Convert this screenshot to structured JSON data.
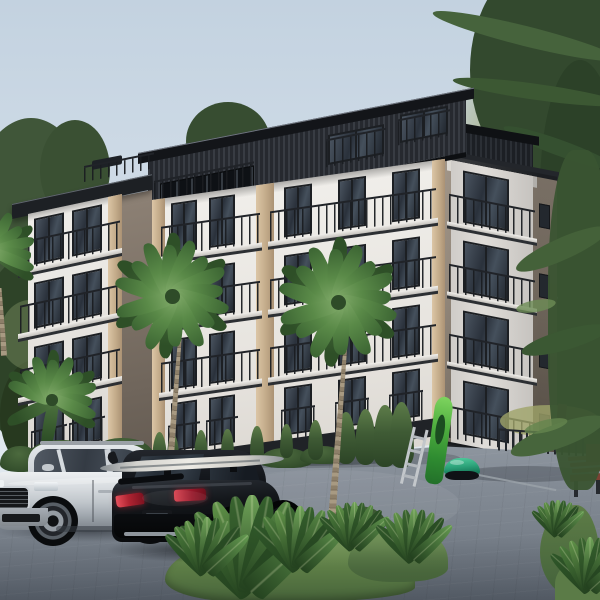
{
  "scene": {
    "type": "photorealistic architectural rendering",
    "subject": "Modern four-storey apartment building with dark ribbed rooftop penthouse, white and beige facades, black metal balcony railings, palm trees, parked cars and a landscaped paved courtyard",
    "time_of_day": "soft overcast daylight",
    "camera": "street-level three-quarter view from the front-left"
  },
  "colors": {
    "sky_top": "#c3d2e0",
    "sky_mid": "#d4dfe9",
    "sky_low": "#e0e8ef",
    "roof_dark": "#131519",
    "penthouse_a": "#26292f",
    "penthouse_b": "#383c43",
    "facade_hi": "#f0eeea",
    "facade_lo": "#dcd8d2",
    "accent_beige": "#cdb394",
    "column_hi": "#8d8175",
    "column_lo": "#635a51",
    "side_hi": "#978b7e",
    "side_lo": "#675e54",
    "window_frame": "#1c1f23",
    "glass_dark": "#2a313b",
    "glass_light": "#4d5865",
    "railing": "#202328",
    "slab_hi": "#f2f0ec",
    "slab_shadow": "#2c2f33",
    "plinth": "#202327",
    "pave_hi": "#8f97a0",
    "pave_lo": "#5f6771",
    "grass_hi": "#7a9a5e",
    "grass_lo": "#46633a",
    "tree_dark": "#33492e",
    "tree_mid": "#43603a",
    "tree_light": "#93a070",
    "willow": "#a3ad80",
    "palm_leaf": "#6f9e5a",
    "palm_leaf_dark": "#3f6234",
    "palm_trunk": "#93856f",
    "car_silver": "#c9ced4",
    "car_black": "#15171b",
    "taillight_red": "#b02432",
    "kayak_green": "#4fae3f",
    "mower_green": "#2fa57c",
    "bench_wood": "#8a4a3a"
  },
  "objects": {
    "building": {
      "storeys_visible": 4,
      "penthouse_level": true,
      "balcony_rows_front_facade": 3,
      "balcony_stack_side_facade": 4,
      "left_wing_balconies": 4,
      "rooftop_terrace_railing": true,
      "ground_floor": "french balconies behind hedge row, dark plinth"
    },
    "vehicles": [
      {
        "kind": "SUV",
        "color_name": "silver",
        "view": "front three-quarter, nose to the left"
      },
      {
        "kind": "compact SUV",
        "color_name": "black",
        "view": "rear three-quarter",
        "roof_cargo": "surfboard on roof rack"
      }
    ],
    "vegetation": {
      "palm_trees": 4,
      "thuja_hedge_cones": 11,
      "shrub_mounds": 7,
      "tropical_leaf_plants": 7,
      "background": "pines left, large conifers and light willow right"
    },
    "props": [
      {
        "name": "kayak",
        "color_name": "green",
        "state": "leaning on wall"
      },
      {
        "name": "ladder",
        "state": "leaning beside kayak"
      },
      {
        "name": "robotic lawn mower",
        "color_name": "teal-green"
      },
      {
        "name": "wooden bench",
        "color_name": "red-brown"
      },
      {
        "name": "garden fence",
        "location": "right edge"
      }
    ]
  },
  "layout": {
    "facades": {
      "A": {
        "left": 152,
        "top": 200,
        "w": 293,
        "h": 284,
        "skew": -8,
        "stories": [
          0,
          68,
          136
        ],
        "winOff": 6,
        "winH": 50,
        "wins": [
          [
            19,
            26
          ],
          [
            57,
            26
          ],
          [
            132,
            28
          ],
          [
            186,
            28
          ],
          [
            240,
            28
          ]
        ],
        "slabs": [
          [
            9,
            99
          ],
          [
            118,
            166
          ]
        ],
        "railOff": 28,
        "railH": 30,
        "slabOff": 58,
        "slabH": 8,
        "ground": {
          "top": 206,
          "winH": 48,
          "railOff": 228,
          "railH": 28
        },
        "pilasters": [
          [
            0,
            13
          ],
          [
            104,
            18
          ],
          [
            280,
            13
          ]
        ],
        "plinth": [
          258,
          18
        ]
      },
      "B": {
        "left": 28,
        "top": 214,
        "w": 94,
        "h": 262,
        "skew": -12,
        "stories": [
          0,
          64,
          128
        ],
        "winOff": 6,
        "winH": 46,
        "wins": [
          [
            6,
            30
          ],
          [
            44,
            30
          ]
        ],
        "slabs": [
          [
            -8,
            100
          ]
        ],
        "railOff": 26,
        "railH": 28,
        "slabOff": 54,
        "slabH": 8,
        "ground": {
          "top": 198,
          "winH": 44,
          "railOff": 218,
          "railH": 26
        },
        "pilasters": [
          [
            80,
            14
          ]
        ],
        "plinth": [
          248,
          14
        ]
      },
      "C": {
        "left": 445,
        "top": 155,
        "w": 112,
        "h": 302,
        "skew": 11,
        "bay": {
          "x": 6,
          "w": 82,
          "stories": [
            8,
            78,
            148
          ],
          "winX": 12,
          "winW": 46,
          "winH": 52,
          "railOff": 30,
          "railH": 28,
          "slabOff": 58,
          "slabH": 7,
          "ground": {
            "top": 222,
            "winH": 54,
            "railOff": 250,
            "railH": 30
          }
        },
        "smalls": {
          "x": 94,
          "w": 11,
          "h": 24,
          "tops": [
            30,
            100,
            170,
            240
          ]
        },
        "step": [
          2,
          286,
          102,
          14
        ],
        "plinth": [
          288,
          14
        ]
      }
    },
    "hedges": {
      "cones": [
        [
          152,
          432,
          40
        ],
        [
          167,
          434,
          32
        ],
        [
          194,
          430,
          38
        ],
        [
          221,
          429,
          33
        ],
        [
          250,
          426,
          36
        ],
        [
          280,
          424,
          34
        ],
        [
          308,
          420,
          40
        ],
        [
          336,
          412,
          52
        ],
        [
          355,
          409,
          56
        ],
        [
          373,
          405,
          62
        ],
        [
          389,
          402,
          66
        ]
      ],
      "mounds": [
        [
          146,
          452,
          48,
          22
        ],
        [
          203,
          452,
          56,
          20
        ],
        [
          260,
          448,
          52,
          20
        ],
        [
          300,
          446,
          46,
          18
        ],
        [
          26,
          440,
          72,
          30
        ],
        [
          92,
          438,
          62,
          26
        ],
        [
          0,
          446,
          42,
          26
        ]
      ]
    },
    "palms": [
      {
        "cx": 172,
        "cy": 296,
        "r": 58,
        "trunk": [
          180,
          330,
          191,
          472,
          9
        ],
        "type": "full"
      },
      {
        "cx": 338,
        "cy": 302,
        "r": 60,
        "trunk": [
          346,
          338,
          361,
          528,
          10
        ],
        "type": "full"
      },
      {
        "cx": 52,
        "cy": 400,
        "r": 46,
        "trunk": [
          47,
          432,
          41,
          508,
          7
        ],
        "type": "fan"
      },
      {
        "cx": -8,
        "cy": 254,
        "r": 44,
        "trunk": [
          0,
          288,
          -4,
          356,
          8
        ],
        "type": "fan"
      }
    ],
    "palm_angles": {
      "dark": [
        -150,
        -90,
        -35,
        30,
        95,
        150
      ],
      "main": [
        -168,
        -142,
        -118,
        -95,
        -72,
        -50,
        -28,
        -8,
        12,
        34,
        58,
        84,
        112,
        138,
        160
      ],
      "fan": [
        -162,
        -138,
        -114,
        -91,
        -68,
        -44,
        -20,
        0,
        18
      ]
    },
    "plants": [
      [
        252,
        592,
        2.1
      ],
      [
        207,
        572,
        1.2
      ],
      [
        300,
        568,
        1.35
      ],
      [
        354,
        548,
        1.0
      ],
      [
        414,
        560,
        1.1
      ],
      [
        590,
        590,
        1.15
      ],
      [
        558,
        534,
        0.75
      ]
    ],
    "leaf_angles": [
      -48,
      -35,
      -22,
      -10,
      0,
      10,
      22,
      35,
      48
    ],
    "leaf_colors": [
      "#2f5729",
      "#4a7a3b",
      "#5f9148",
      "#3a6530",
      "#6fa258",
      "#35602d",
      "#578745",
      "#2b5026",
      "#639850"
    ]
  }
}
